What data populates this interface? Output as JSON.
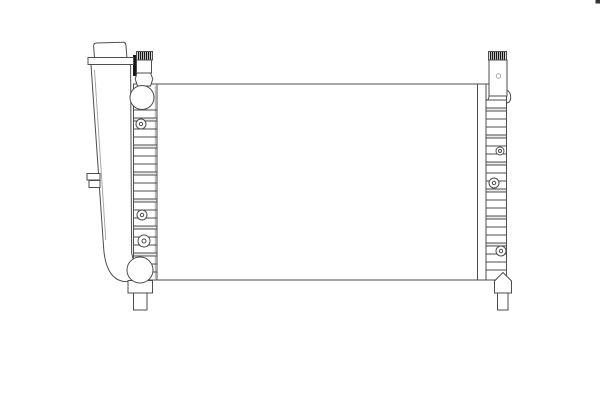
{
  "image": {
    "alt": "Technical line drawing of an automotive engine cooling radiator: rectangular core, segmented left and right side tanks, integrated expansion tank with filler cap and overflow nipple on the left, round inlet and outlet hose ports, serrated top brackets and two bottom mounting pins",
    "background": "#ffffff",
    "line": "#4d4d4d",
    "line_light": "#a8a8a8",
    "line_dark": "#181818",
    "shade": "#ececec",
    "corner_mark": "#343434"
  }
}
